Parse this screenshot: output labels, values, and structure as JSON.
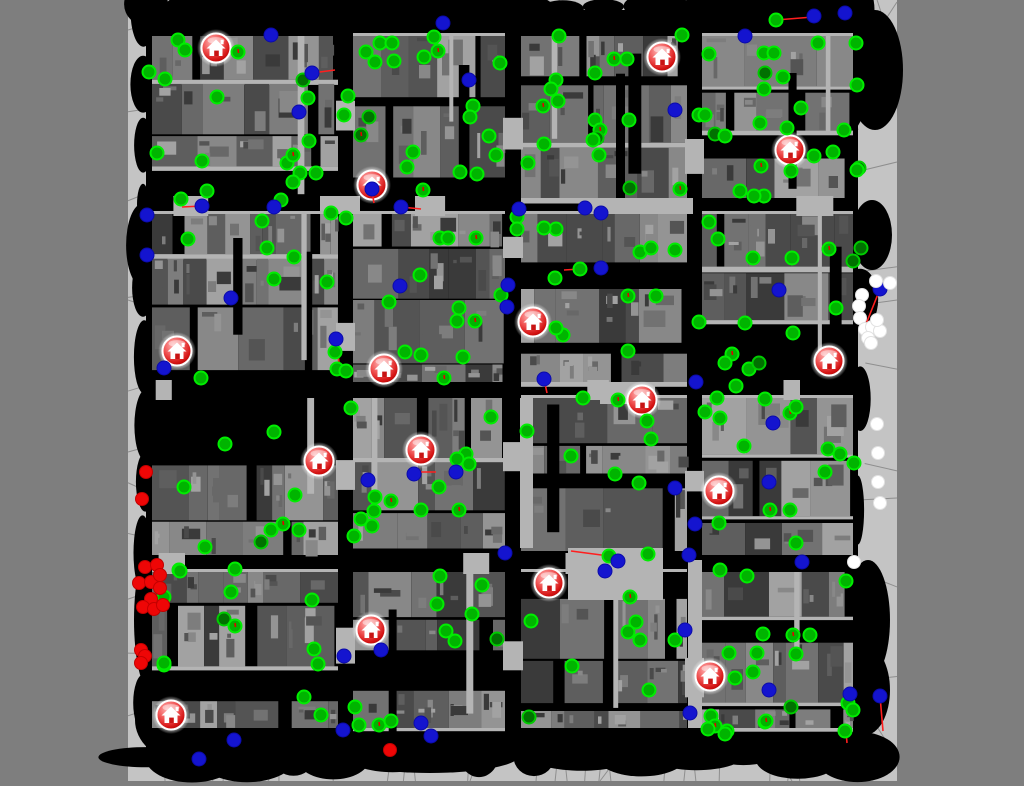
{
  "scene": {
    "width": 1024,
    "height": 786,
    "outer_color": "#7e7e7e",
    "map": {
      "x": 128,
      "y": 0,
      "w": 769,
      "h": 781,
      "bg": "#c4c4c4",
      "mesh_line_color": "#8e8e8e"
    }
  },
  "palette": {
    "street": "#000000",
    "building_grays": [
      "#4a4a4a",
      "#545454",
      "#5e5e5e",
      "#686868",
      "#727272",
      "#7d7d7d",
      "#888888",
      "#949494",
      "#a2a2a2",
      "#3a3a3a"
    ],
    "walkway": "#b4b4b4",
    "agent_green_fill": "#00b400",
    "agent_green_ring": "#00ee00",
    "agent_darkgreen_fill": "#017101",
    "agent_blue": "#1414cf",
    "agent_red": "#ee0606",
    "agent_white": "#ffffff",
    "trajectory": "#ff1e1e",
    "house_ring": "#ffffff",
    "house_door": "#c81414"
  },
  "mesh": {
    "seed": 5,
    "lines": [
      [
        897,
        2,
        846,
        80
      ],
      [
        846,
        80,
        858,
        130
      ],
      [
        128,
        300,
        146,
        306
      ],
      [
        128,
        452,
        146,
        447
      ],
      [
        860,
        305,
        897,
        300
      ],
      [
        858,
        500,
        897,
        498
      ],
      [
        640,
        728,
        600,
        781
      ],
      [
        758,
        728,
        792,
        781
      ],
      [
        300,
        728,
        268,
        781
      ],
      [
        490,
        728,
        470,
        781
      ],
      [
        160,
        10,
        188,
        0
      ],
      [
        540,
        12,
        560,
        0
      ],
      [
        860,
        700,
        897,
        758
      ]
    ]
  },
  "city": {
    "seed": 20,
    "blob_seed": 7,
    "lane_seed": 11,
    "content": [
      146,
      10,
      858,
      756
    ],
    "cols": [
      [
        152,
        338
      ],
      [
        353,
        505
      ],
      [
        521,
        687
      ],
      [
        702,
        853
      ]
    ],
    "rows": [
      [
        36,
        198
      ],
      [
        214,
        382
      ],
      [
        398,
        555
      ],
      [
        572,
        728
      ]
    ],
    "blobs": [
      [
        875,
        70,
        28,
        60
      ],
      [
        872,
        235,
        20,
        35
      ],
      [
        868,
        620,
        22,
        60
      ],
      [
        865,
        690,
        25,
        45
      ],
      [
        180,
        720,
        45,
        40
      ],
      [
        430,
        755,
        90,
        18
      ],
      [
        520,
        20,
        60,
        16
      ],
      [
        250,
        25,
        60,
        18
      ],
      [
        150,
        250,
        14,
        60
      ],
      [
        150,
        620,
        16,
        70
      ],
      [
        835,
        100,
        30,
        40
      ],
      [
        600,
        742,
        80,
        16
      ]
    ],
    "plazas": [
      [
        568,
        548,
        95,
        52
      ],
      [
        600,
        382,
        55,
        22
      ],
      [
        688,
        560,
        14,
        168
      ],
      [
        520,
        398,
        13,
        150
      ],
      [
        320,
        196,
        40,
        18
      ],
      [
        583,
        198,
        110,
        16
      ]
    ]
  },
  "houses": [
    [
      216,
      48
    ],
    [
      662,
      57
    ],
    [
      790,
      150
    ],
    [
      372,
      185
    ],
    [
      533,
      322
    ],
    [
      177,
      351
    ],
    [
      384,
      369
    ],
    [
      829,
      361
    ],
    [
      642,
      400
    ],
    [
      421,
      450
    ],
    [
      319,
      461
    ],
    [
      719,
      491
    ],
    [
      549,
      583
    ],
    [
      371,
      630
    ],
    [
      710,
      676
    ],
    [
      171,
      715
    ]
  ],
  "trajectories": [
    [
      312,
      73,
      335,
      70
    ],
    [
      202,
      206,
      182,
      207
    ],
    [
      401,
      207,
      421,
      209
    ],
    [
      776,
      20,
      813,
      17
    ],
    [
      880,
      289,
      866,
      324
    ],
    [
      880,
      696,
      883,
      731
    ],
    [
      580,
      269,
      564,
      270
    ],
    [
      609,
      556,
      571,
      551
    ],
    [
      544,
      379,
      547,
      393
    ],
    [
      336,
      342,
      339,
      362
    ],
    [
      372,
      192,
      374,
      203
    ],
    [
      415,
      472,
      436,
      472
    ],
    [
      846,
      731,
      847,
      743
    ]
  ],
  "agents": [
    [
      178,
      40,
      "g"
    ],
    [
      185,
      50,
      "g"
    ],
    [
      238,
      52,
      "g"
    ],
    [
      149,
      72,
      "g"
    ],
    [
      165,
      79,
      "g"
    ],
    [
      380,
      43,
      "g"
    ],
    [
      392,
      43,
      "g"
    ],
    [
      366,
      52,
      "g"
    ],
    [
      375,
      62,
      "g"
    ],
    [
      394,
      61,
      "g"
    ],
    [
      424,
      57,
      "g"
    ],
    [
      438,
      51,
      "g"
    ],
    [
      434,
      37,
      "g"
    ],
    [
      500,
      63,
      "g"
    ],
    [
      217,
      97,
      "g"
    ],
    [
      303,
      80,
      "d"
    ],
    [
      308,
      98,
      "g"
    ],
    [
      348,
      96,
      "g"
    ],
    [
      344,
      115,
      "g"
    ],
    [
      369,
      117,
      "d"
    ],
    [
      361,
      135,
      "d"
    ],
    [
      473,
      106,
      "g"
    ],
    [
      470,
      117,
      "g"
    ],
    [
      489,
      136,
      "g"
    ],
    [
      496,
      155,
      "g"
    ],
    [
      309,
      141,
      "g"
    ],
    [
      157,
      153,
      "g"
    ],
    [
      202,
      161,
      "g"
    ],
    [
      287,
      163,
      "g"
    ],
    [
      293,
      155,
      "g"
    ],
    [
      300,
      173,
      "g"
    ],
    [
      316,
      173,
      "g"
    ],
    [
      293,
      182,
      "g"
    ],
    [
      207,
      191,
      "g"
    ],
    [
      413,
      152,
      "g"
    ],
    [
      407,
      167,
      "g"
    ],
    [
      460,
      172,
      "g"
    ],
    [
      477,
      174,
      "g"
    ],
    [
      423,
      190,
      "g"
    ],
    [
      181,
      199,
      "g"
    ],
    [
      281,
      200,
      "g"
    ],
    [
      331,
      213,
      "g"
    ],
    [
      346,
      218,
      "g"
    ],
    [
      262,
      221,
      "g"
    ],
    [
      188,
      239,
      "g"
    ],
    [
      440,
      238,
      "g"
    ],
    [
      448,
      238,
      "g"
    ],
    [
      476,
      238,
      "g"
    ],
    [
      267,
      248,
      "g"
    ],
    [
      294,
      257,
      "g"
    ],
    [
      274,
      279,
      "g"
    ],
    [
      327,
      282,
      "g"
    ],
    [
      420,
      275,
      "g"
    ],
    [
      389,
      302,
      "g"
    ],
    [
      459,
      308,
      "g"
    ],
    [
      457,
      321,
      "g"
    ],
    [
      475,
      321,
      "g"
    ],
    [
      501,
      295,
      "g"
    ],
    [
      335,
      352,
      "g"
    ],
    [
      405,
      352,
      "g"
    ],
    [
      421,
      355,
      "g"
    ],
    [
      463,
      357,
      "g"
    ],
    [
      337,
      369,
      "g"
    ],
    [
      346,
      371,
      "g"
    ],
    [
      201,
      378,
      "g"
    ],
    [
      444,
      378,
      "g"
    ],
    [
      559,
      36,
      "g"
    ],
    [
      682,
      35,
      "g"
    ],
    [
      776,
      20,
      "g"
    ],
    [
      818,
      43,
      "g"
    ],
    [
      856,
      43,
      "g"
    ],
    [
      709,
      54,
      "g"
    ],
    [
      764,
      53,
      "g"
    ],
    [
      774,
      53,
      "g"
    ],
    [
      614,
      59,
      "g"
    ],
    [
      627,
      59,
      "g"
    ],
    [
      595,
      73,
      "g"
    ],
    [
      765,
      73,
      "d"
    ],
    [
      783,
      77,
      "g"
    ],
    [
      764,
      89,
      "g"
    ],
    [
      556,
      80,
      "g"
    ],
    [
      551,
      89,
      "g"
    ],
    [
      558,
      101,
      "g"
    ],
    [
      543,
      106,
      "g"
    ],
    [
      801,
      108,
      "g"
    ],
    [
      857,
      85,
      "g"
    ],
    [
      844,
      130,
      "g"
    ],
    [
      699,
      115,
      "g"
    ],
    [
      705,
      115,
      "g"
    ],
    [
      715,
      134,
      "d"
    ],
    [
      725,
      136,
      "g"
    ],
    [
      595,
      120,
      "g"
    ],
    [
      600,
      130,
      "g"
    ],
    [
      544,
      144,
      "g"
    ],
    [
      597,
      138,
      "d"
    ],
    [
      629,
      120,
      "g"
    ],
    [
      760,
      123,
      "g"
    ],
    [
      787,
      128,
      "g"
    ],
    [
      833,
      152,
      "g"
    ],
    [
      814,
      156,
      "g"
    ],
    [
      859,
      168,
      "d"
    ],
    [
      761,
      166,
      "g"
    ],
    [
      791,
      171,
      "g"
    ],
    [
      764,
      196,
      "g"
    ],
    [
      740,
      191,
      "g"
    ],
    [
      754,
      196,
      "g"
    ],
    [
      528,
      163,
      "g"
    ],
    [
      599,
      155,
      "g"
    ],
    [
      593,
      140,
      "g"
    ],
    [
      630,
      188,
      "d"
    ],
    [
      680,
      189,
      "g"
    ],
    [
      857,
      170,
      "g"
    ],
    [
      709,
      222,
      "g"
    ],
    [
      718,
      239,
      "g"
    ],
    [
      640,
      252,
      "g"
    ],
    [
      651,
      248,
      "g"
    ],
    [
      675,
      250,
      "g"
    ],
    [
      753,
      258,
      "g"
    ],
    [
      792,
      258,
      "g"
    ],
    [
      829,
      249,
      "g"
    ],
    [
      861,
      248,
      "d"
    ],
    [
      853,
      261,
      "d"
    ],
    [
      556,
      229,
      "g"
    ],
    [
      544,
      228,
      "g"
    ],
    [
      517,
      217,
      "g"
    ],
    [
      517,
      229,
      "g"
    ],
    [
      580,
      269,
      "g"
    ],
    [
      555,
      278,
      "g"
    ],
    [
      628,
      296,
      "g"
    ],
    [
      656,
      296,
      "g"
    ],
    [
      628,
      351,
      "g"
    ],
    [
      563,
      335,
      "g"
    ],
    [
      556,
      328,
      "g"
    ],
    [
      699,
      322,
      "g"
    ],
    [
      745,
      323,
      "g"
    ],
    [
      793,
      333,
      "g"
    ],
    [
      836,
      308,
      "g"
    ],
    [
      732,
      354,
      "g"
    ],
    [
      725,
      363,
      "g"
    ],
    [
      749,
      369,
      "g"
    ],
    [
      736,
      386,
      "g"
    ],
    [
      759,
      363,
      "d"
    ],
    [
      225,
      444,
      "g"
    ],
    [
      274,
      432,
      "g"
    ],
    [
      184,
      487,
      "g"
    ],
    [
      295,
      495,
      "g"
    ],
    [
      283,
      524,
      "g"
    ],
    [
      271,
      530,
      "g"
    ],
    [
      261,
      542,
      "d"
    ],
    [
      205,
      547,
      "g"
    ],
    [
      299,
      530,
      "g"
    ],
    [
      179,
      570,
      "g"
    ],
    [
      235,
      569,
      "g"
    ],
    [
      231,
      592,
      "g"
    ],
    [
      224,
      619,
      "d"
    ],
    [
      235,
      626,
      "g"
    ],
    [
      164,
      665,
      "g"
    ],
    [
      312,
      600,
      "g"
    ],
    [
      314,
      649,
      "g"
    ],
    [
      318,
      664,
      "g"
    ],
    [
      304,
      697,
      "g"
    ],
    [
      321,
      715,
      "g"
    ],
    [
      355,
      707,
      "g"
    ],
    [
      359,
      725,
      "g"
    ],
    [
      379,
      725,
      "g"
    ],
    [
      391,
      721,
      "g"
    ],
    [
      351,
      408,
      "g"
    ],
    [
      491,
      417,
      "g"
    ],
    [
      466,
      454,
      "g"
    ],
    [
      469,
      464,
      "g"
    ],
    [
      457,
      459,
      "g"
    ],
    [
      439,
      487,
      "g"
    ],
    [
      421,
      510,
      "g"
    ],
    [
      459,
      510,
      "g"
    ],
    [
      440,
      576,
      "g"
    ],
    [
      482,
      585,
      "g"
    ],
    [
      437,
      604,
      "g"
    ],
    [
      472,
      614,
      "g"
    ],
    [
      446,
      631,
      "g"
    ],
    [
      455,
      641,
      "g"
    ],
    [
      497,
      639,
      "d"
    ],
    [
      375,
      497,
      "g"
    ],
    [
      391,
      501,
      "g"
    ],
    [
      374,
      511,
      "g"
    ],
    [
      361,
      519,
      "g"
    ],
    [
      372,
      526,
      "g"
    ],
    [
      354,
      536,
      "g"
    ],
    [
      180,
      571,
      "g"
    ],
    [
      164,
      597,
      "g"
    ],
    [
      164,
      663,
      "g"
    ],
    [
      583,
      398,
      "g"
    ],
    [
      618,
      400,
      "g"
    ],
    [
      527,
      431,
      "g"
    ],
    [
      571,
      456,
      "g"
    ],
    [
      615,
      474,
      "g"
    ],
    [
      639,
      483,
      "g"
    ],
    [
      647,
      421,
      "g"
    ],
    [
      651,
      439,
      "g"
    ],
    [
      717,
      398,
      "g"
    ],
    [
      765,
      399,
      "g"
    ],
    [
      790,
      413,
      "g"
    ],
    [
      796,
      407,
      "g"
    ],
    [
      705,
      412,
      "g"
    ],
    [
      720,
      418,
      "g"
    ],
    [
      744,
      446,
      "g"
    ],
    [
      828,
      449,
      "g"
    ],
    [
      840,
      454,
      "g"
    ],
    [
      854,
      463,
      "g"
    ],
    [
      825,
      472,
      "g"
    ],
    [
      770,
      510,
      "g"
    ],
    [
      790,
      510,
      "g"
    ],
    [
      796,
      543,
      "g"
    ],
    [
      719,
      523,
      "g"
    ],
    [
      720,
      570,
      "g"
    ],
    [
      747,
      576,
      "g"
    ],
    [
      846,
      581,
      "g"
    ],
    [
      609,
      556,
      "g"
    ],
    [
      648,
      554,
      "g"
    ],
    [
      630,
      597,
      "g"
    ],
    [
      636,
      622,
      "g"
    ],
    [
      628,
      632,
      "g"
    ],
    [
      640,
      640,
      "g"
    ],
    [
      675,
      640,
      "g"
    ],
    [
      531,
      621,
      "g"
    ],
    [
      572,
      666,
      "g"
    ],
    [
      649,
      690,
      "g"
    ],
    [
      763,
      634,
      "g"
    ],
    [
      793,
      635,
      "g"
    ],
    [
      810,
      635,
      "g"
    ],
    [
      729,
      653,
      "g"
    ],
    [
      757,
      653,
      "g"
    ],
    [
      796,
      654,
      "g"
    ],
    [
      753,
      672,
      "g"
    ],
    [
      735,
      678,
      "g"
    ],
    [
      529,
      717,
      "d"
    ],
    [
      711,
      716,
      "g"
    ],
    [
      715,
      726,
      "g"
    ],
    [
      708,
      729,
      "g"
    ],
    [
      727,
      731,
      "g"
    ],
    [
      725,
      734,
      "g"
    ],
    [
      765,
      722,
      "g"
    ],
    [
      848,
      703,
      "g"
    ],
    [
      853,
      710,
      "g"
    ],
    [
      791,
      707,
      "d"
    ],
    [
      845,
      731,
      "g"
    ],
    [
      766,
      721,
      "g"
    ],
    [
      271,
      35,
      "b"
    ],
    [
      443,
      23,
      "b"
    ],
    [
      312,
      73,
      "b"
    ],
    [
      469,
      80,
      "b"
    ],
    [
      299,
      112,
      "b"
    ],
    [
      147,
      215,
      "b"
    ],
    [
      202,
      206,
      "b"
    ],
    [
      274,
      207,
      "b"
    ],
    [
      372,
      189,
      "b"
    ],
    [
      401,
      207,
      "b"
    ],
    [
      147,
      255,
      "b"
    ],
    [
      231,
      298,
      "b"
    ],
    [
      400,
      286,
      "b"
    ],
    [
      508,
      285,
      "b"
    ],
    [
      507,
      307,
      "b"
    ],
    [
      336,
      339,
      "b"
    ],
    [
      164,
      368,
      "b"
    ],
    [
      814,
      16,
      "b"
    ],
    [
      845,
      13,
      "b"
    ],
    [
      745,
      36,
      "b"
    ],
    [
      675,
      110,
      "b"
    ],
    [
      519,
      209,
      "b"
    ],
    [
      585,
      208,
      "b"
    ],
    [
      601,
      213,
      "b"
    ],
    [
      601,
      268,
      "b"
    ],
    [
      779,
      290,
      "b"
    ],
    [
      880,
      289,
      "b"
    ],
    [
      544,
      379,
      "b"
    ],
    [
      696,
      382,
      "b"
    ],
    [
      368,
      480,
      "b"
    ],
    [
      414,
      474,
      "b"
    ],
    [
      456,
      472,
      "b"
    ],
    [
      505,
      553,
      "b"
    ],
    [
      381,
      650,
      "b"
    ],
    [
      344,
      656,
      "b"
    ],
    [
      343,
      730,
      "b"
    ],
    [
      421,
      723,
      "b"
    ],
    [
      431,
      736,
      "b"
    ],
    [
      234,
      740,
      "b"
    ],
    [
      199,
      759,
      "b"
    ],
    [
      773,
      423,
      "b"
    ],
    [
      675,
      488,
      "b"
    ],
    [
      769,
      482,
      "b"
    ],
    [
      695,
      524,
      "b"
    ],
    [
      618,
      561,
      "b"
    ],
    [
      605,
      571,
      "b"
    ],
    [
      689,
      555,
      "b"
    ],
    [
      802,
      562,
      "b"
    ],
    [
      685,
      630,
      "b"
    ],
    [
      769,
      690,
      "b"
    ],
    [
      850,
      694,
      "b"
    ],
    [
      880,
      696,
      "b"
    ],
    [
      690,
      713,
      "b"
    ],
    [
      146,
      472,
      "r"
    ],
    [
      142,
      499,
      "r"
    ],
    [
      145,
      567,
      "r"
    ],
    [
      157,
      565,
      "r"
    ],
    [
      139,
      583,
      "r"
    ],
    [
      151,
      582,
      "r"
    ],
    [
      160,
      575,
      "r"
    ],
    [
      160,
      588,
      "r"
    ],
    [
      151,
      599,
      "r"
    ],
    [
      143,
      607,
      "r"
    ],
    [
      154,
      609,
      "r"
    ],
    [
      163,
      605,
      "r"
    ],
    [
      141,
      650,
      "r"
    ],
    [
      145,
      656,
      "r"
    ],
    [
      141,
      663,
      "r"
    ],
    [
      390,
      750,
      "r"
    ],
    [
      890,
      283,
      "w"
    ],
    [
      876,
      281,
      "w"
    ],
    [
      862,
      295,
      "w"
    ],
    [
      859,
      306,
      "w"
    ],
    [
      860,
      318,
      "w"
    ],
    [
      865,
      329,
      "w"
    ],
    [
      872,
      327,
      "w"
    ],
    [
      880,
      331,
      "w"
    ],
    [
      868,
      338,
      "w"
    ],
    [
      877,
      320,
      "w"
    ],
    [
      871,
      343,
      "w"
    ],
    [
      877,
      424,
      "w"
    ],
    [
      878,
      453,
      "w"
    ],
    [
      878,
      482,
      "w"
    ],
    [
      880,
      503,
      "w"
    ],
    [
      854,
      562,
      "w"
    ]
  ]
}
